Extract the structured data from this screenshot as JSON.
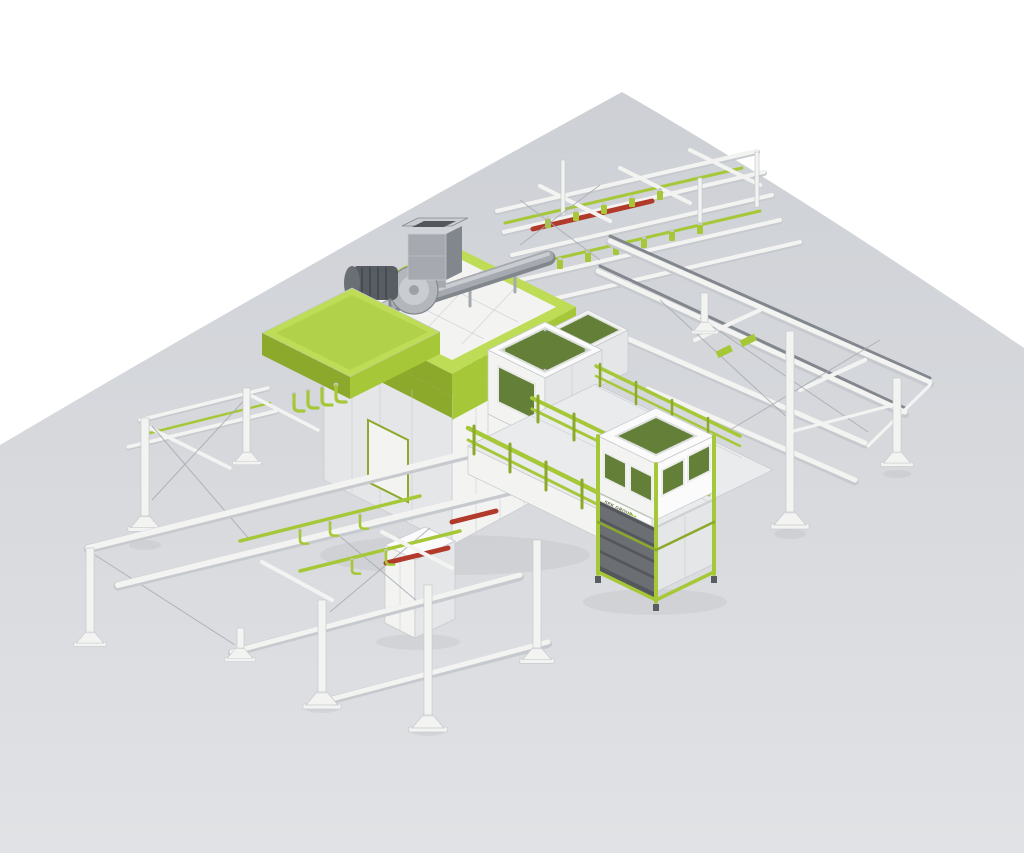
{
  "labels": {
    "booth_brand": "SPK",
    "booth_brand_sub": "GROUP",
    "filter_unit_label": "SPK GROUP"
  },
  "colors": {
    "background": "#ffffff",
    "floor": "#d2d4d9",
    "floor_light": "#e2e3e6",
    "lime": "#a6c838",
    "lime_bright": "#bedc55",
    "lime_dark": "#8ca92c",
    "panel": "#f3f4f2",
    "panel_shade": "#e4e6e8",
    "panel_dark": "#c6c9cd",
    "steel": "#a6aab0",
    "steel_dark": "#82878d",
    "motor": "#585d63",
    "mesh_green": "#4e682a",
    "mesh_line": "#7e9c49",
    "red": "#b13a2b",
    "cable": "#a7abb1",
    "drawer": "#6b6e72",
    "logo_text": "#5a682b"
  }
}
